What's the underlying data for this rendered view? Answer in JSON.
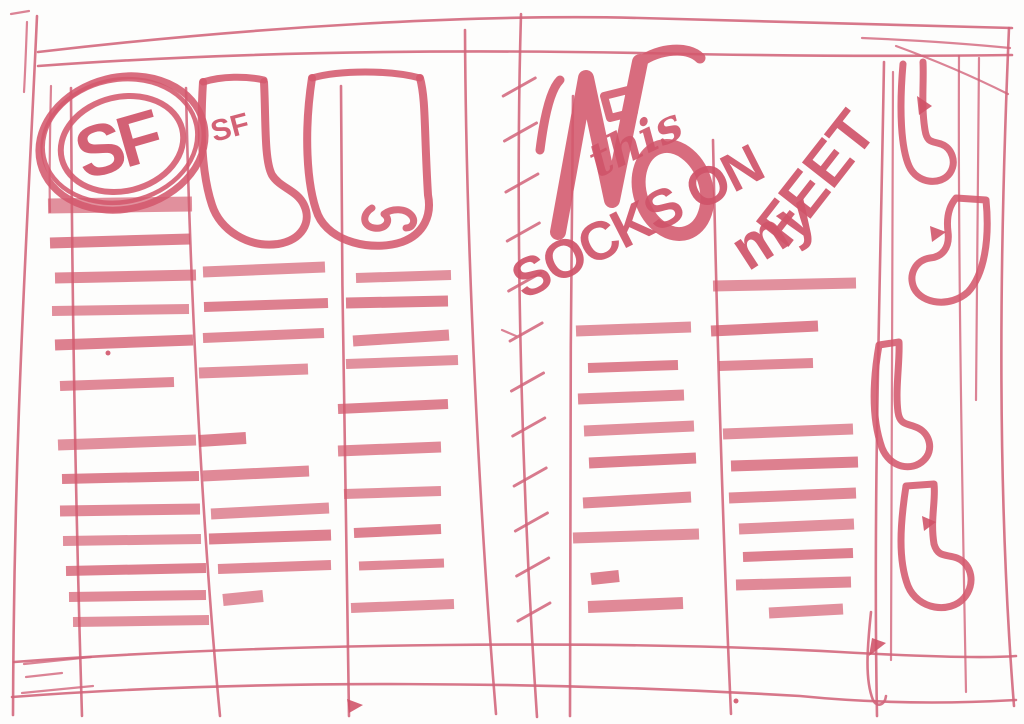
{
  "page": {
    "kind": "hand-drawn webpage wireframe sketch, pink marker on white paper",
    "logo": {
      "text": "SF"
    },
    "sock_tag": "SF",
    "headline": {
      "script_word": "this",
      "word1": "SOCKS ON",
      "word2": "my",
      "word3": "FEET",
      "reading": "socks on my feet"
    },
    "colors": {
      "marker": "#d4596d",
      "marker_dark": "#c84e62",
      "marker_light": "#e08d9c",
      "paper": "#fdfdfc"
    }
  },
  "sketch_bars": {
    "col1": [
      [
        48,
        192,
        206,
        15,
        -2
      ],
      [
        50,
        190,
        243,
        11,
        -4
      ],
      [
        55,
        196,
        278,
        11,
        -3
      ],
      [
        52,
        189,
        311,
        10,
        -2
      ],
      [
        55,
        193,
        345,
        11,
        -5
      ],
      [
        60,
        174,
        386,
        10,
        -4
      ],
      [
        58,
        196,
        445,
        11,
        -5
      ],
      [
        62,
        199,
        479,
        10,
        -3
      ],
      [
        60,
        200,
        511,
        11,
        -2
      ],
      [
        63,
        201,
        541,
        10,
        -2
      ],
      [
        66,
        206,
        571,
        10,
        -3
      ],
      [
        69,
        206,
        597,
        10,
        -2
      ],
      [
        73,
        209,
        622,
        10,
        -2
      ]
    ],
    "col2": [
      [
        203,
        325,
        272,
        11,
        -5
      ],
      [
        204,
        328,
        307,
        10,
        -4
      ],
      [
        203,
        324,
        338,
        10,
        -5
      ],
      [
        199,
        308,
        373,
        11,
        -4
      ],
      [
        199,
        246,
        441,
        12,
        -3
      ],
      [
        203,
        309,
        476,
        11,
        -5
      ],
      [
        211,
        329,
        514,
        11,
        -6
      ],
      [
        209,
        331,
        539,
        11,
        -4
      ],
      [
        218,
        331,
        569,
        10,
        -4
      ],
      [
        223,
        263,
        600,
        12,
        -4
      ]
    ],
    "col3": [
      [
        356,
        451,
        278,
        10,
        -3
      ],
      [
        346,
        448,
        303,
        11,
        -2
      ],
      [
        353,
        449,
        341,
        11,
        -6
      ],
      [
        346,
        458,
        364,
        10,
        -4
      ],
      [
        338,
        448,
        409,
        10,
        -5
      ],
      [
        338,
        441,
        451,
        11,
        -4
      ],
      [
        344,
        441,
        494,
        10,
        -3
      ],
      [
        354,
        441,
        533,
        10,
        -4
      ],
      [
        359,
        444,
        566,
        9,
        -3
      ],
      [
        351,
        454,
        608,
        10,
        -4
      ]
    ],
    "col4": [
      [
        576,
        691,
        331,
        11,
        -4
      ],
      [
        588,
        678,
        368,
        10,
        -3
      ],
      [
        578,
        684,
        399,
        11,
        -4
      ],
      [
        584,
        694,
        431,
        11,
        -5
      ],
      [
        589,
        696,
        463,
        11,
        -5
      ],
      [
        583,
        691,
        503,
        11,
        -6
      ],
      [
        573,
        699,
        538,
        11,
        -4
      ],
      [
        591,
        619,
        579,
        12,
        -3
      ],
      [
        588,
        683,
        607,
        12,
        -4
      ]
    ],
    "col5": [
      [
        713,
        856,
        286,
        11,
        -3
      ],
      [
        711,
        818,
        331,
        11,
        -5
      ],
      [
        719,
        813,
        366,
        10,
        -3
      ],
      [
        723,
        853,
        434,
        11,
        -5
      ],
      [
        731,
        858,
        466,
        11,
        -4
      ],
      [
        729,
        856,
        498,
        11,
        -5
      ],
      [
        739,
        854,
        529,
        11,
        -5
      ],
      [
        743,
        853,
        557,
        10,
        -4
      ],
      [
        736,
        851,
        585,
        11,
        -3
      ],
      [
        769,
        843,
        613,
        11,
        -4
      ]
    ]
  },
  "binding": {
    "tick_ys": [
      88,
      133,
      184,
      233,
      283,
      333,
      383,
      428,
      478,
      523,
      568,
      613
    ]
  }
}
